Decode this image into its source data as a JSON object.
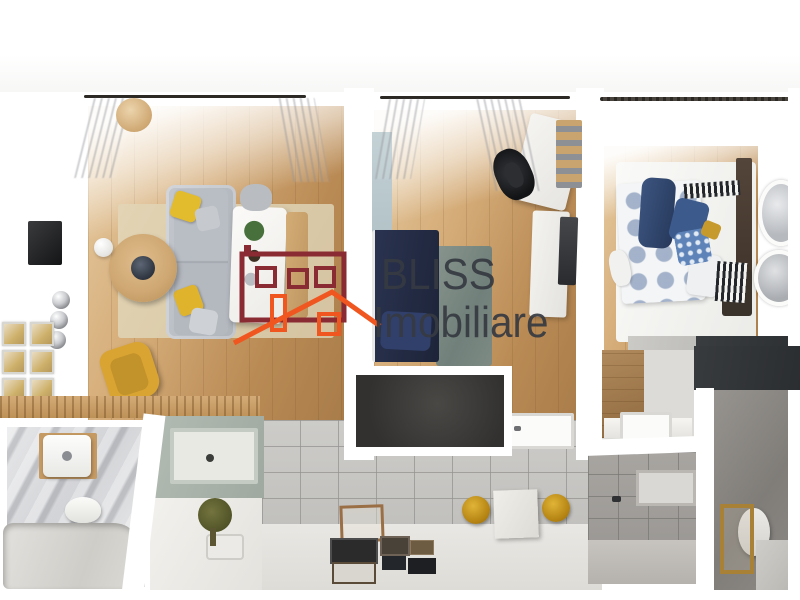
{
  "image": {
    "type": "3D top-down cutaway render of an apartment floor plan",
    "width_px": 800,
    "height_px": 600
  },
  "watermark": {
    "brand_line1": "BLISS",
    "brand_line2": "Imobiliare",
    "text_color": "#363a42",
    "logo": {
      "name": "house-outline-logo",
      "body_color": "#8a2a33",
      "roof_color": "#f0561f"
    }
  },
  "rooms": [
    {
      "name": "living-room",
      "features": [
        "gray-sofa",
        "yellow-pillows",
        "round-wood-coffee-table",
        "white-dining-table",
        "plant",
        "yellow-armchair",
        "wall-tv",
        "gallery-wall",
        "pendant-sphere-lights",
        "rattan-pendant-lamp",
        "beige-rug",
        "curtains"
      ]
    },
    {
      "name": "office-room",
      "features": [
        "navy-daybed",
        "teal-rug",
        "desk",
        "black-office-chair",
        "shelf-unit",
        "white-wardrobe",
        "wall-tv",
        "light-blue-wall-panel",
        "curtains",
        "shower-tray"
      ]
    },
    {
      "name": "bedroom",
      "features": [
        "double-bed",
        "blue-floral-duvet",
        "navy-blanket",
        "blue-pillows",
        "striped-throws",
        "dark-headboard",
        "round-wall-mirrors",
        "wardrobe",
        "curtains",
        "shower-tray"
      ]
    },
    {
      "name": "bathroom-left",
      "features": [
        "marble-walls",
        "wall-sink",
        "wood-shelf",
        "toilet",
        "bathtub"
      ]
    },
    {
      "name": "kitchen-area",
      "features": [
        "wood-countertop",
        "sage-green-cabinet",
        "potted-plant",
        "white-counter"
      ]
    },
    {
      "name": "lower-hallway",
      "features": [
        "gray-tiled-wall",
        "picture-frames-on-floor",
        "empty-wood-frame",
        "yellow-wall-knobs",
        "white-box",
        "dark-wall-panel"
      ]
    },
    {
      "name": "bathroom-right",
      "features": [
        "gray-tiles",
        "wall-niche",
        "toilet",
        "gold-frame",
        "bathtub-edge",
        "dark-wall-band"
      ]
    }
  ],
  "palette": {
    "wood_floor": "#cda26c",
    "sofa_gray": "#b6bac1",
    "accent_yellow": "#ddb12e",
    "navy_bed": "#232a41",
    "teal_rug": "#7d8b84",
    "sage_cabinet": "#a9b3aa",
    "tile_gray": "#c9c8c5",
    "dark_panel": "#3c3b38",
    "bed_blue": "#5d83b8",
    "marble_gray": "#d0d1d4"
  }
}
